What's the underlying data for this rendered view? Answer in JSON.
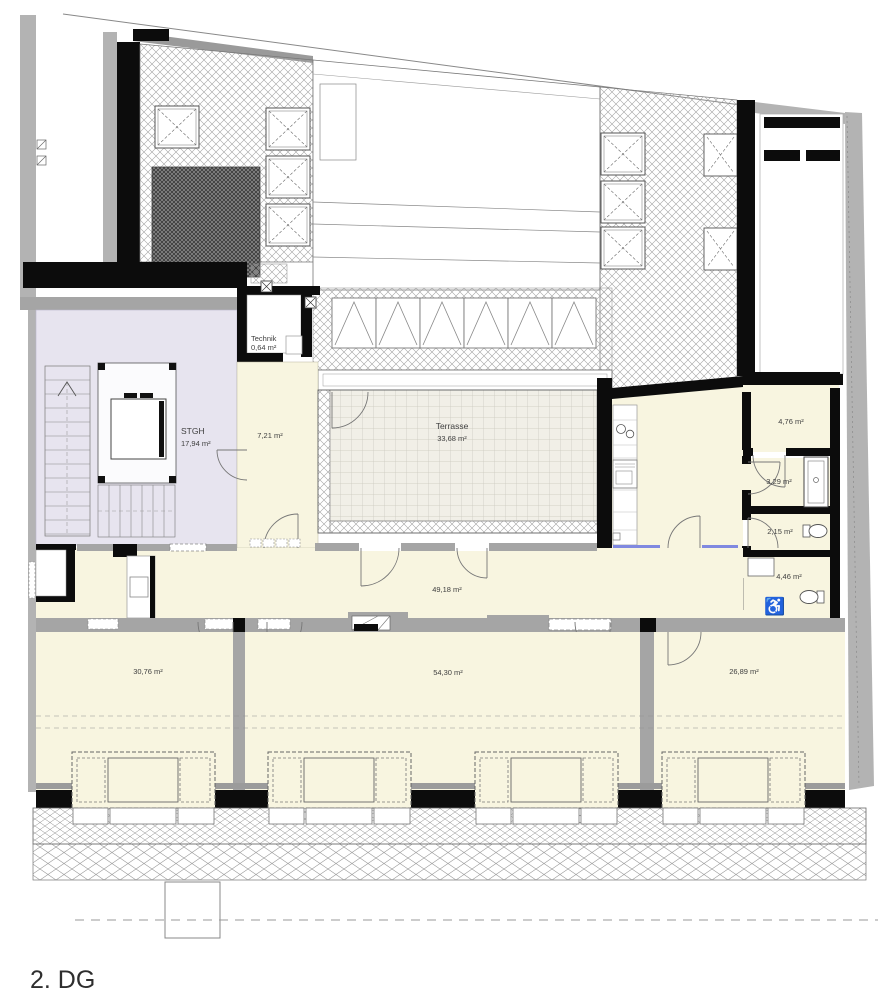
{
  "floor_label": "2. DG",
  "rooms": {
    "stgh": {
      "name": "STGH",
      "area": "17,94 m²"
    },
    "technik": {
      "name": "Technik",
      "area": "0,64 m²"
    },
    "flur": {
      "area": "7,21 m²"
    },
    "terrasse": {
      "name": "Terrasse",
      "area": "33,68 m²"
    },
    "wohnkueche": {
      "area": "49,18 m²"
    },
    "abstellraum": {
      "area": "4,76 m²"
    },
    "dusche": {
      "area": "3,29 m²"
    },
    "wc": {
      "area": "2,15 m²"
    },
    "bad": {
      "area": "4,46 m²"
    },
    "zimmer_links": {
      "area": "30,76 m²"
    },
    "zimmer_mitte": {
      "area": "54,30 m²"
    },
    "zimmer_rechts": {
      "area": "26,89 m²"
    }
  },
  "icons": {
    "accessible_wc": "♿"
  },
  "colors": {
    "room_fill": "#f8f5e0",
    "stairwell_fill": "#e7e4ef",
    "terrace_fill": "#f1efe7",
    "wall_black": "#0c0c0c",
    "wall_gray": "#a5a5a5",
    "neighbor_gray": "#b3b3b3",
    "glazing_blue": "#8089e0",
    "label_text": "#3f3f3f"
  }
}
